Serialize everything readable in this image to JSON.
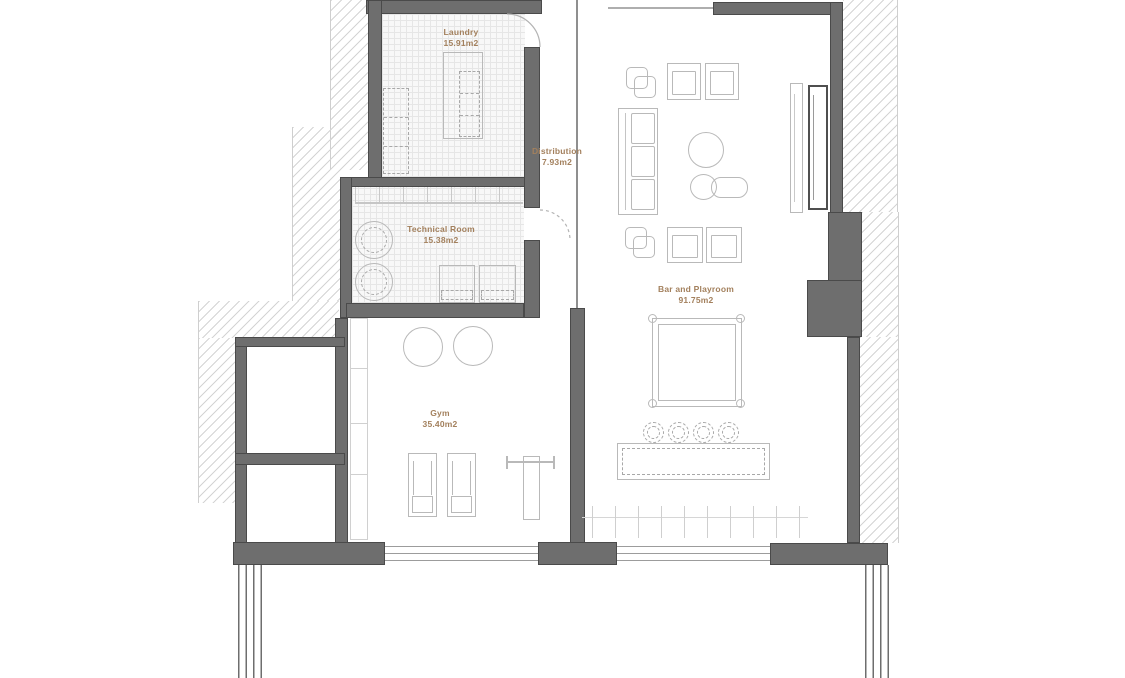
{
  "rooms": {
    "laundry": {
      "name": "Laundry",
      "area": "15.91m2"
    },
    "distribution": {
      "name": "Distribution",
      "area": "7.93m2"
    },
    "technical_room": {
      "name": "Technical Room",
      "area": "15.38m2"
    },
    "gym": {
      "name": "Gym",
      "area": "35.40m2"
    },
    "bar_playroom": {
      "name": "Bar and Playroom",
      "area": "91.75m2"
    }
  },
  "colors": {
    "wall": "#6e6e6e",
    "wall_outline": "#4a4a4a",
    "label_text": "#a3805d",
    "furniture_line": "#b9b9b9",
    "hatch_line": "#d4d4d4",
    "floor_grid": "#e6e6e6"
  }
}
